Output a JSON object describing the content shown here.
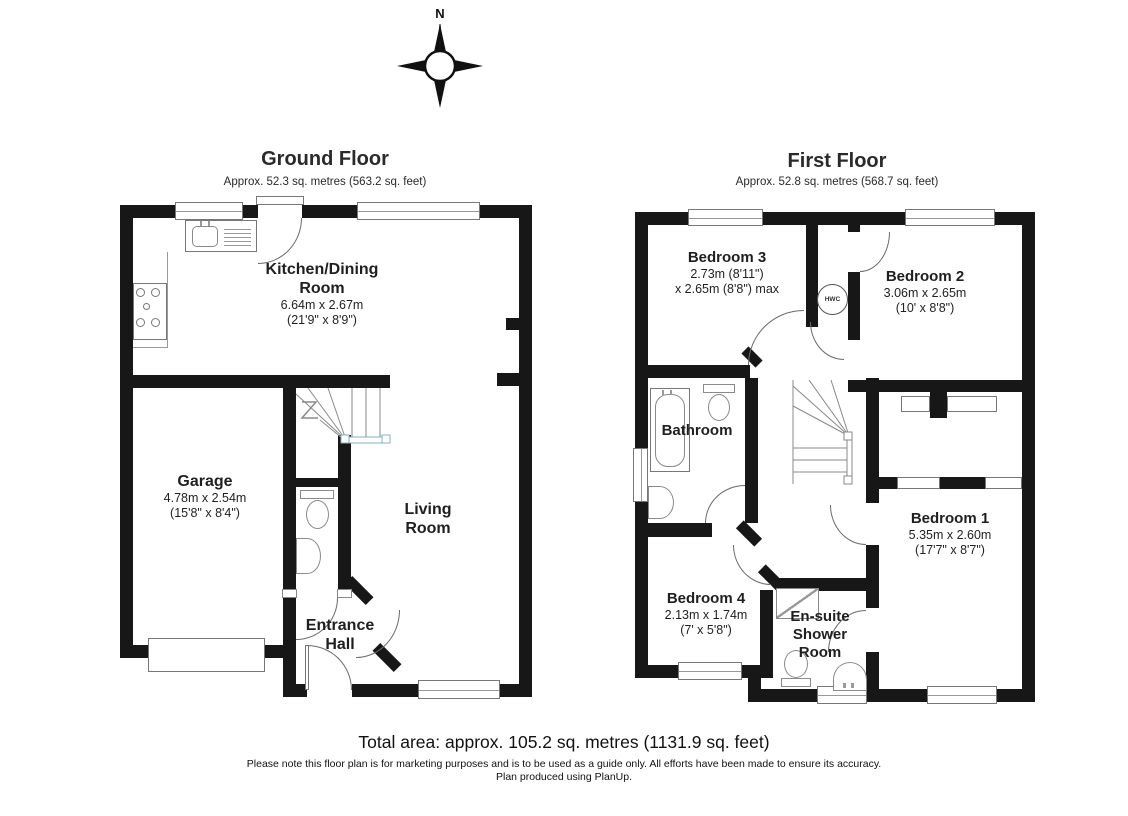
{
  "compass": {
    "north_label": "N"
  },
  "ground_floor": {
    "title": "Ground Floor",
    "subtitle": "Approx. 52.3 sq. metres (563.2 sq. feet)",
    "rooms": {
      "kitchen": {
        "name_line1": "Kitchen/Dining",
        "name_line2": "Room",
        "dims_metric": "6.64m x 2.67m",
        "dims_imperial": "(21'9\" x 8'9\")"
      },
      "garage": {
        "name": "Garage",
        "dims_metric": "4.78m x 2.54m",
        "dims_imperial": "(15'8\" x 8'4\")"
      },
      "living": {
        "name_line1": "Living",
        "name_line2": "Room"
      },
      "hall": {
        "name_line1": "Entrance",
        "name_line2": "Hall"
      }
    }
  },
  "first_floor": {
    "title": "First Floor",
    "subtitle": "Approx. 52.8 sq. metres (568.7 sq. feet)",
    "rooms": {
      "bedroom3": {
        "name": "Bedroom 3",
        "dims_line1": "2.73m (8'11\")",
        "dims_line2": "x 2.65m (8'8\") max"
      },
      "bedroom2": {
        "name": "Bedroom 2",
        "dims_metric": "3.06m x 2.65m",
        "dims_imperial": "(10' x 8'8\")"
      },
      "bedroom1": {
        "name": "Bedroom 1",
        "dims_metric": "5.35m x 2.60m",
        "dims_imperial": "(17'7\" x 8'7\")"
      },
      "bedroom4": {
        "name": "Bedroom 4",
        "dims_metric": "2.13m x 1.74m",
        "dims_imperial": "(7' x 5'8\")"
      },
      "bathroom": {
        "name": "Bathroom"
      },
      "ensuite": {
        "name_line1": "En-suite",
        "name_line2": "Shower",
        "name_line3": "Room"
      },
      "hwc": {
        "label": "HWC"
      }
    }
  },
  "footer": {
    "total_area": "Total area: approx. 105.2 sq. metres (1131.9 sq. feet)",
    "disclaimer": "Please note this floor plan is for marketing purposes and is to be used as a guide only. All efforts have been made to ensure its accuracy.",
    "produced": "Plan produced using PlanUp."
  },
  "colors": {
    "wall": "#171717",
    "line": "#6a6a6a",
    "text": "#1f1f1f"
  }
}
